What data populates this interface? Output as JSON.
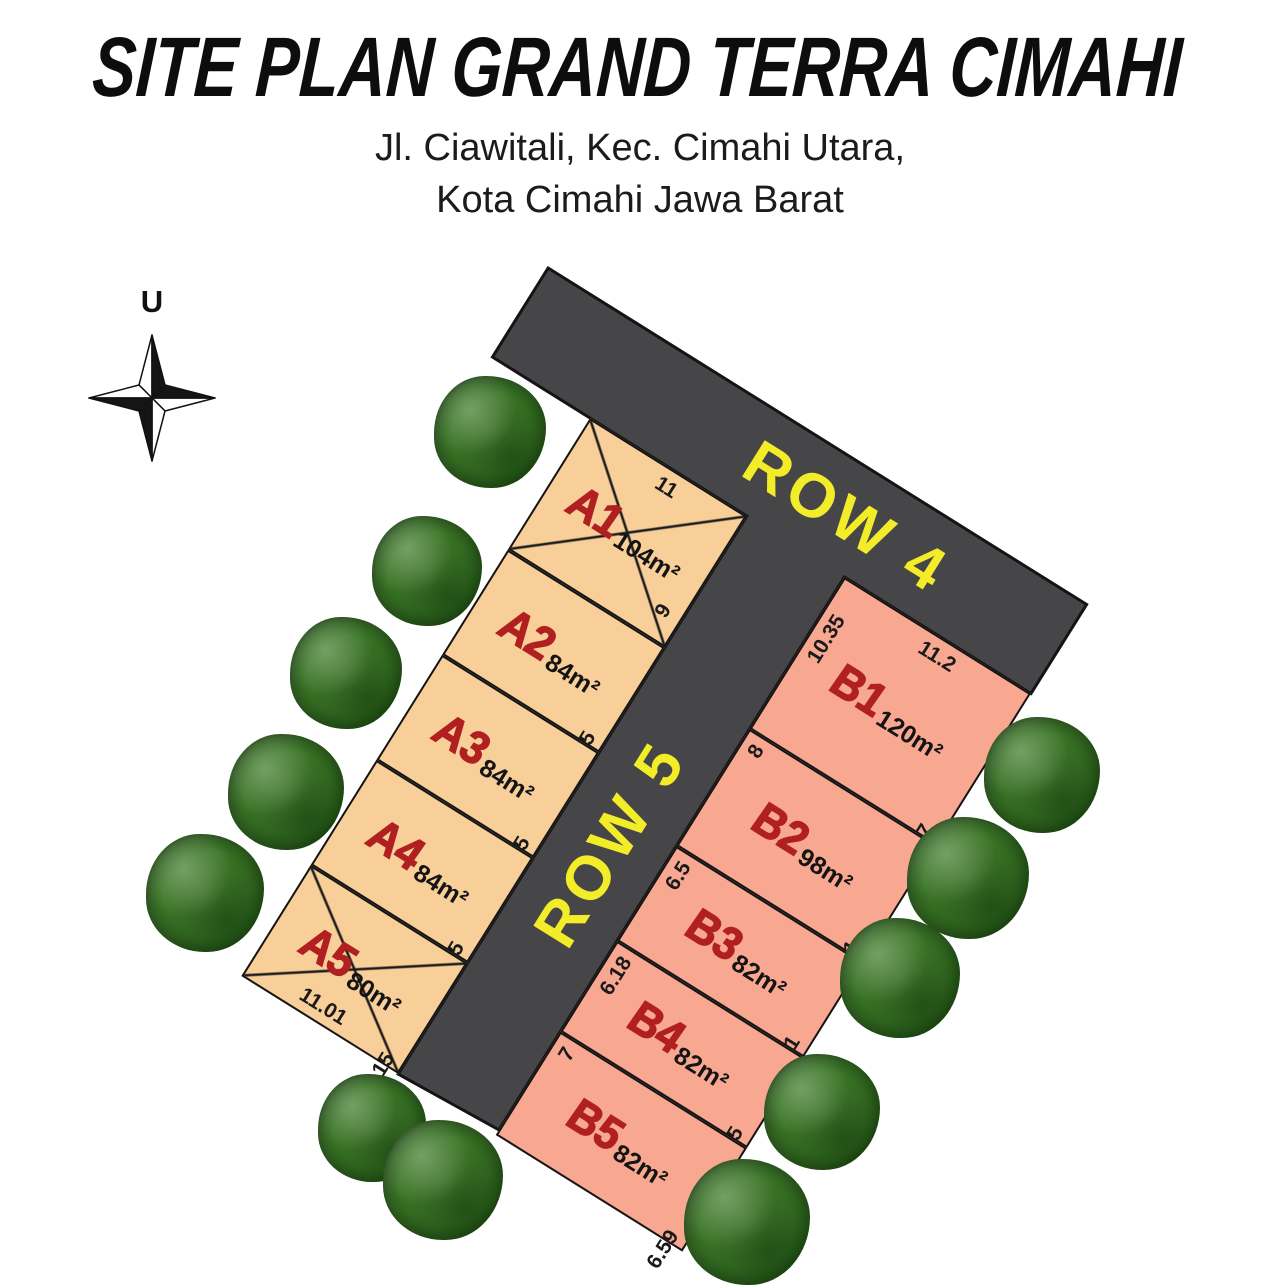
{
  "title": "SITE PLAN GRAND TERRA CIMAHI",
  "subtitle": {
    "line1": "Jl. Ciawitali, Kec. Cimahi Utara,",
    "line2": "Kota Cimahi Jawa Barat"
  },
  "compass": {
    "north_label": "U"
  },
  "roads": {
    "row4_label": "ROW 4",
    "row5_label": "ROW 5"
  },
  "blocks": {
    "a": [
      {
        "code": "A1",
        "area": "104m²",
        "dim_top": "11",
        "dim_right": "9",
        "crossed": true
      },
      {
        "code": "A2",
        "area": "84m²",
        "dim_right": "7.5",
        "crossed": false
      },
      {
        "code": "A3",
        "area": "84m²",
        "dim_right": "7.5",
        "crossed": false
      },
      {
        "code": "A4",
        "area": "84m²",
        "dim_right": "7.5",
        "crossed": false
      },
      {
        "code": "A5",
        "area": "80m²",
        "dim_right": "7.15",
        "dim_bottom": "11.01",
        "crossed": true
      }
    ],
    "b": [
      {
        "code": "B1",
        "area": "120m²",
        "dim_top": "11.2",
        "dim_left": "10.35",
        "dim_right": "11.67",
        "crossed": false
      },
      {
        "code": "B2",
        "area": "98m²",
        "dim_left": "8",
        "dim_right": "6.71",
        "crossed": false
      },
      {
        "code": "B3",
        "area": "82m²",
        "dim_left": "6.5",
        "dim_right": "6.51",
        "crossed": false
      },
      {
        "code": "B4",
        "area": "82m²",
        "dim_left": "6.18",
        "dim_right": "5.15",
        "crossed": false
      },
      {
        "code": "B5",
        "area": "82m²",
        "dim_left": "7",
        "dim_right": "6.59",
        "crossed": false
      }
    ]
  },
  "colors": {
    "lot_a_fill": "#f8ce99",
    "lot_b_fill": "#f8a791",
    "road_fill": "#464649",
    "road_label": "#f3ec28",
    "lot_code": "#b02020"
  }
}
